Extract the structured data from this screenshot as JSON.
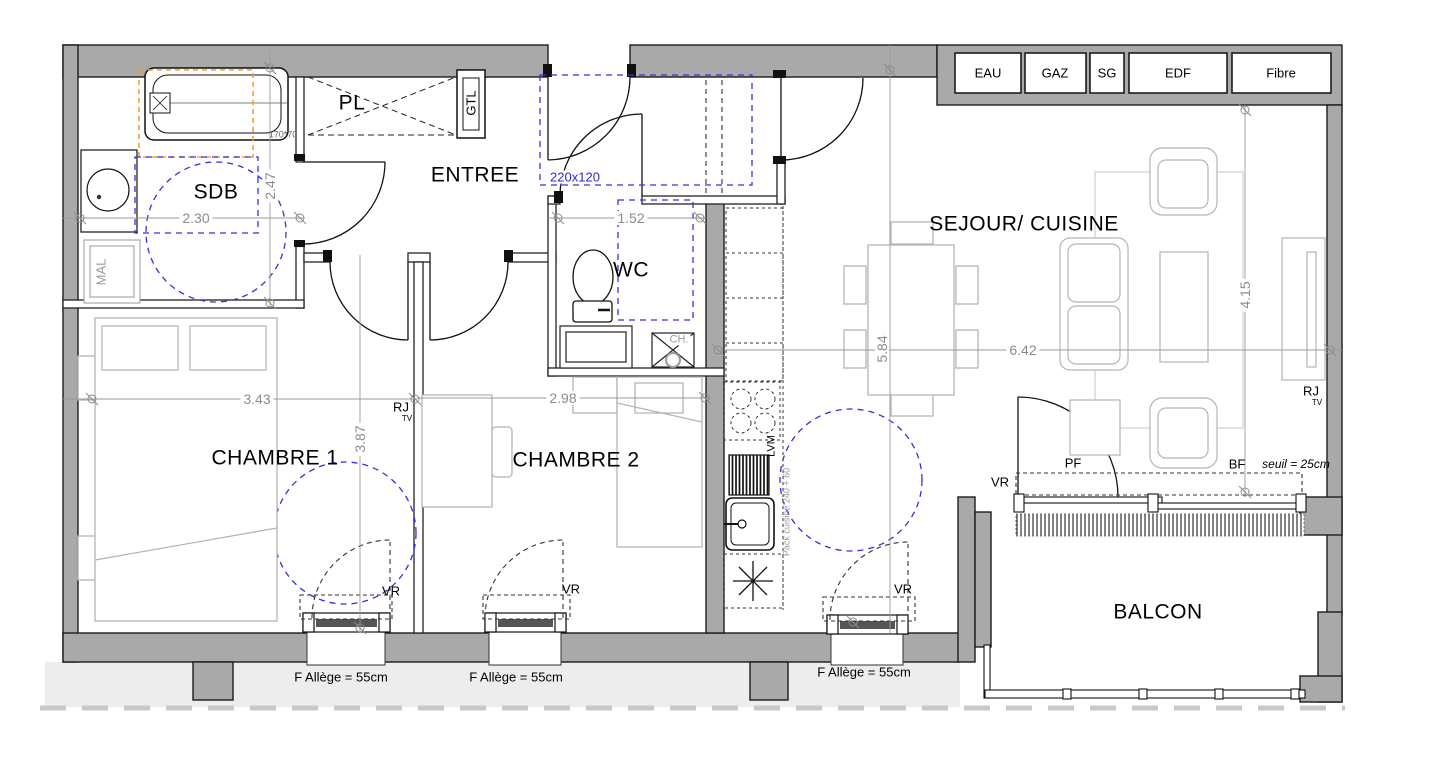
{
  "utility_boxes": [
    "EAU",
    "GAZ",
    "SG",
    "EDF",
    "Fibre"
  ],
  "rooms": {
    "sdb": "SDB",
    "pl": "PL",
    "entree": "ENTREE",
    "wc": "WC",
    "sejour_cuisine": "SEJOUR/ CUISINE",
    "chambre1": "CHAMBRE 1",
    "chambre2": "CHAMBRE 2",
    "balcon": "BALCON"
  },
  "dimensions": {
    "sdb_width": "2.30",
    "sdb_depth": "2.47",
    "wc_width": "1.52",
    "entree_clearance": "220x120",
    "chambre1_width": "3.43",
    "chambre1_depth": "3.87",
    "chambre2_width": "2.98",
    "sejour_depth": "5.84",
    "sejour_width": "6.42",
    "salon_depth": "4.15",
    "bathtub_size": "170*70"
  },
  "equipment": {
    "gtl": "GTL",
    "mal": "MAL",
    "ch": "CH.",
    "lvm": "LVM",
    "pack_cuisine": "Pack cuisine 240 + 60",
    "rj": "RJ",
    "tv": "TV"
  },
  "openings": {
    "vr": "VR",
    "pf": "PF",
    "bf": "BF",
    "seuil": "seuil = 25cm",
    "f_allege": "F  Allège = 55cm"
  },
  "colors": {
    "wall_fill": "#a9a9a9",
    "accessibility_blue": "#3232dc",
    "reservation_orange": "#ff9a33",
    "furniture_gray": "#b5b5b5",
    "dimension_gray": "#8c8c8c"
  }
}
